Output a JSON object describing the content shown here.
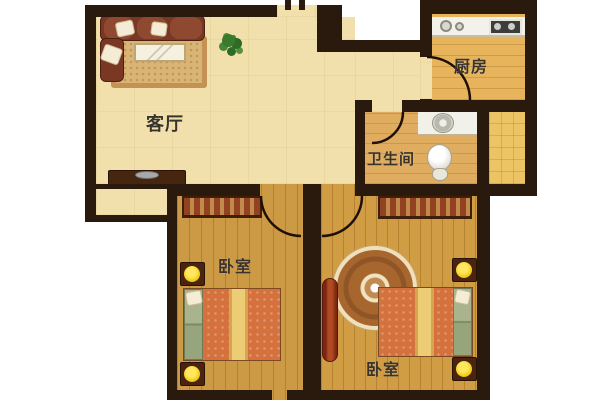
{
  "page": {
    "type": "apartment-floor-plan"
  },
  "rooms": {
    "living_room": {
      "label": "客厅"
    },
    "kitchen": {
      "label": "厨房"
    },
    "bathroom": {
      "label": "卫生间"
    },
    "bedroom_left": {
      "label": "卧室"
    },
    "bedroom_right": {
      "label": "卧室"
    }
  },
  "colors": {
    "wall": "#2a190d",
    "living_floor": "#f1e0ac",
    "kitchen_floor": "#e7b45c",
    "bathroom_floor": "#e0ad60",
    "utility_floor": "#ecc463",
    "bedroom_left_floor": "#cc9945",
    "bedroom_right_floor": "#d09c44",
    "bed": "#d4713d",
    "bed_stripe": "#eccd76",
    "headboard": "#a3af88",
    "lamp_on": "#f7d21a",
    "sofa": "#7a3724",
    "dark_wood": "#47260f",
    "dresser": "#9e3317",
    "rug": "#d9b575",
    "plant": "#2f6d2a"
  }
}
